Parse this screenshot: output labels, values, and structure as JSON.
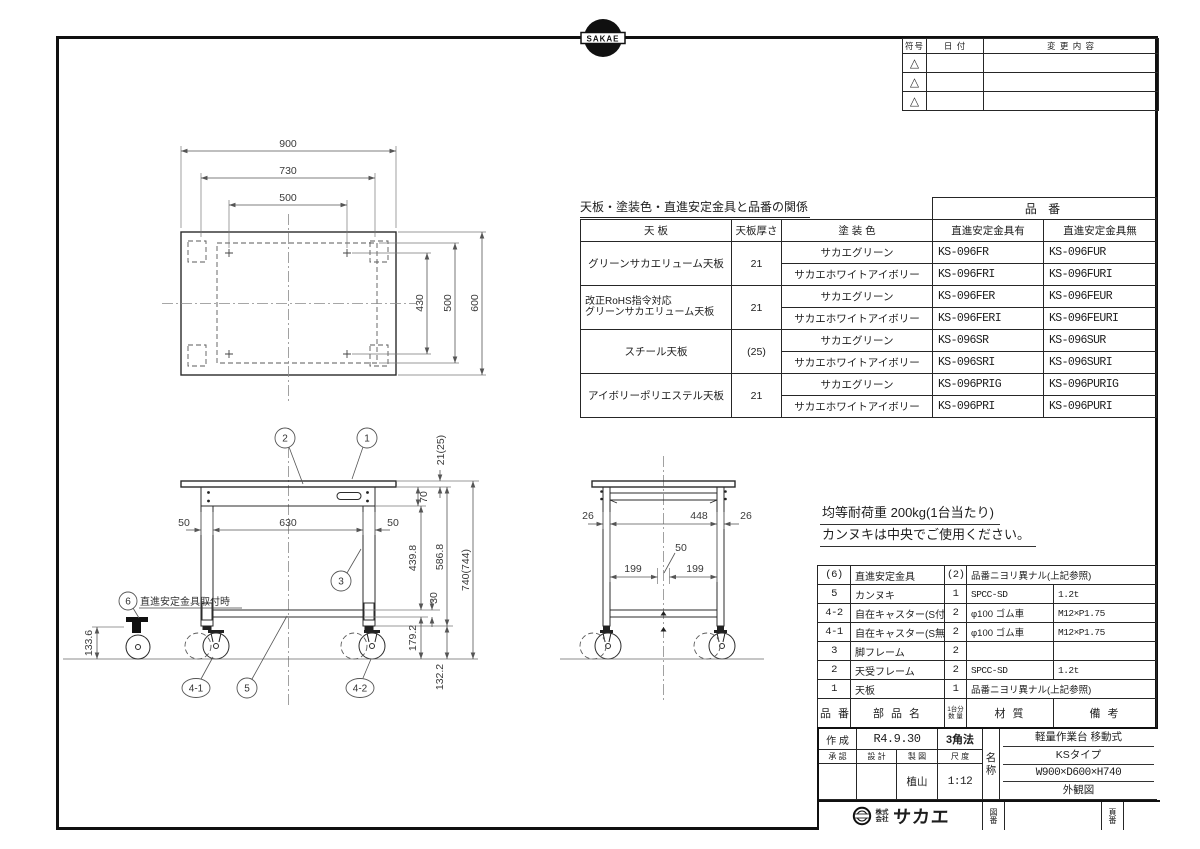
{
  "logo_top": {
    "text": "SAKAE"
  },
  "revision_table": {
    "col_symbol": "符号",
    "col_date": "日 付",
    "col_content": "変 更 内 容",
    "rows": [
      "△",
      "△",
      "△"
    ]
  },
  "relation_table": {
    "title": "天板・塗装色・直進安定金具と品番の関係",
    "part_no_group": "品 番",
    "col_top": "天 板",
    "col_thickness": "天板厚さ",
    "col_color": "塗 装 色",
    "col_with": "直進安定金具有",
    "col_without": "直進安定金具無",
    "groups": [
      {
        "top": "グリーンサカエリューム天板",
        "top2": "",
        "thickness": "21",
        "rows": [
          [
            "サカエグリーン",
            "KS-096FR",
            "KS-096FUR"
          ],
          [
            "サカエホワイトアイボリー",
            "KS-096FRI",
            "KS-096FURI"
          ]
        ]
      },
      {
        "top": "改正RoHS指令対応",
        "top2": "グリーンサカエリューム天板",
        "thickness": "21",
        "rows": [
          [
            "サカエグリーン",
            "KS-096FER",
            "KS-096FEUR"
          ],
          [
            "サカエホワイトアイボリー",
            "KS-096FERI",
            "KS-096FEURI"
          ]
        ]
      },
      {
        "top": "スチール天板",
        "top2": "",
        "thickness": "(25)",
        "rows": [
          [
            "サカエグリーン",
            "KS-096SR",
            "KS-096SUR"
          ],
          [
            "サカエホワイトアイボリー",
            "KS-096SRI",
            "KS-096SURI"
          ]
        ]
      },
      {
        "top": "アイボリーポリエステル天板",
        "top2": "",
        "thickness": "21",
        "rows": [
          [
            "サカエグリーン",
            "KS-096PRIG",
            "KS-096PURIG"
          ],
          [
            "サカエホワイトアイボリー",
            "KS-096PRI",
            "KS-096PURI"
          ]
        ]
      }
    ]
  },
  "load_note": {
    "line1": "均等耐荷重  200kg(1台当たり)",
    "line2": "カンヌキは中央でご使用ください。"
  },
  "parts_table": {
    "headers": {
      "no": "品 番",
      "name": "部 品 名",
      "qty1": "1台分",
      "qty2": "数 量",
      "material": "材  質",
      "remarks": "備  考"
    },
    "rows": [
      {
        "no": "(6)",
        "name": "直進安定金具",
        "qty": "(2)",
        "material": "品番ニヨリ異ナル(上記参照)",
        "remarks": ""
      },
      {
        "no": "5",
        "name": "カンヌキ",
        "qty": "1",
        "material": "SPCC-SD",
        "remarks": "1.2t"
      },
      {
        "no": "4-2",
        "name": "自在キャスター(S付)",
        "qty": "2",
        "material": "φ100 ゴム車",
        "remarks": "M12×P1.75"
      },
      {
        "no": "4-1",
        "name": "自在キャスター(S無)",
        "qty": "2",
        "material": "φ100 ゴム車",
        "remarks": "M12×P1.75"
      },
      {
        "no": "3",
        "name": "脚フレーム",
        "qty": "2",
        "material": "",
        "remarks": ""
      },
      {
        "no": "2",
        "name": "天受フレーム",
        "qty": "2",
        "material": "SPCC-SD",
        "remarks": "1.2t"
      },
      {
        "no": "1",
        "name": "天板",
        "qty": "1",
        "material": "品番ニヨリ異ナル(上記参照)",
        "remarks": ""
      }
    ]
  },
  "title_block": {
    "created_label": "作 成",
    "created_value": "R4.9.30",
    "projection": "3角法",
    "approved_label": "承 認",
    "designed_label": "設 計",
    "drawn_label": "製 図",
    "scale_label": "尺 度",
    "approved_value": "",
    "designed_value": "",
    "drawn_value": "植山",
    "scale_value": "1:12",
    "name_label": "名称",
    "name_line1": "軽量作業台 移動式",
    "name_line2": "KSタイプ",
    "name_line3": "W900×D600×H740",
    "name_line4": "外観図",
    "company_prefix1": "株式",
    "company_prefix2": "会社",
    "company_name": "サカエ",
    "drawing_no_label": "図番",
    "page_no_label": "頁番"
  },
  "drawing": {
    "plan_dims": {
      "w": "900",
      "w_frame": "730",
      "w_inner": "500",
      "d_inner1": "430",
      "d_inner2": "500",
      "d": "600"
    },
    "front_dims": {
      "top_thickness": "21(25)",
      "apron_h": "70",
      "leg_w_left": "50",
      "inner_w": "630",
      "leg_w_right": "50",
      "h1": "439.8",
      "h2": "586.8",
      "h_total": "740(744)",
      "rail_h": "30",
      "h3": "179.2",
      "caster_h": "132.2",
      "stab_caster_h": "133.6"
    },
    "side_dims": {
      "leg_d_left": "26",
      "inner_d": "448",
      "leg_d_right": "26",
      "gap": "50",
      "c1": "199",
      "c2": "199"
    },
    "balloons": {
      "b1": "1",
      "b2": "2",
      "b3": "3",
      "b4_1": "4-1",
      "b4_2": "4-2",
      "b5": "5",
      "b6": "6",
      "b6_note": "直進安定金具取付時"
    }
  }
}
